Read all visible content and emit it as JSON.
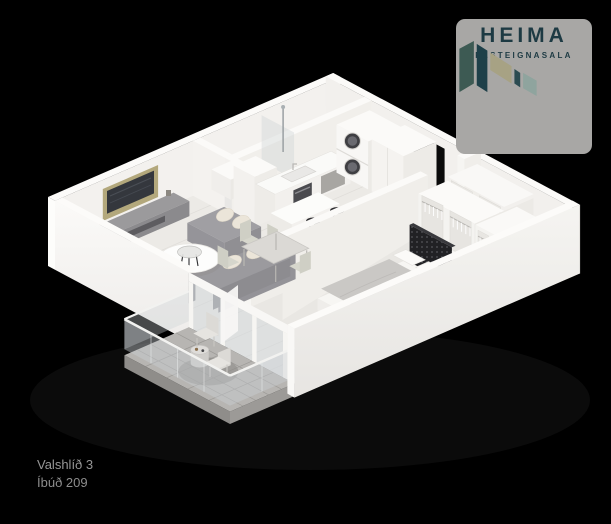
{
  "background_color": "#000000",
  "logo": {
    "brand": "HEIMA",
    "tagline": "FASTEIGNASALA",
    "card_color": "#a8a7a5",
    "text_color": "#1d3a43",
    "icon_colors": {
      "panel_teal": "#3d5a53",
      "panel_navy": "#1e4049",
      "panel_khaki": "#a7a284",
      "panel_dark_sliver": "#2b4b51",
      "panel_gray_green": "#8fa49e"
    }
  },
  "property": {
    "name": "Valshlíð 3",
    "unit": "Íbúð 209",
    "label_color": "#979797"
  },
  "scene": {
    "type": "isometric-3d-floor-plan-render",
    "wall_color": "#f5f4f1",
    "floor_color": "#eceae6",
    "balcony_floor_color": "#b7b5b2",
    "rooms": [
      "living-room",
      "kitchen",
      "dining-area",
      "bathroom",
      "laundry-nook",
      "hallway",
      "bedroom",
      "balcony"
    ],
    "furniture": [
      "sectional-sofa",
      "round-rug-coffee-table",
      "tv-media-wall",
      "kitchen-island",
      "bar-stools",
      "kitchen-counter-with-sink",
      "dining-table-with-chairs",
      "shower",
      "toilet",
      "vanity",
      "stacked-washer-dryer",
      "tall-cabinet",
      "open-wardrobes-with-hangers",
      "double-bed",
      "dark-headboard-panel",
      "balcony-chairs",
      "balcony-table",
      "glass-railing",
      "glass-balcony-doors"
    ]
  }
}
